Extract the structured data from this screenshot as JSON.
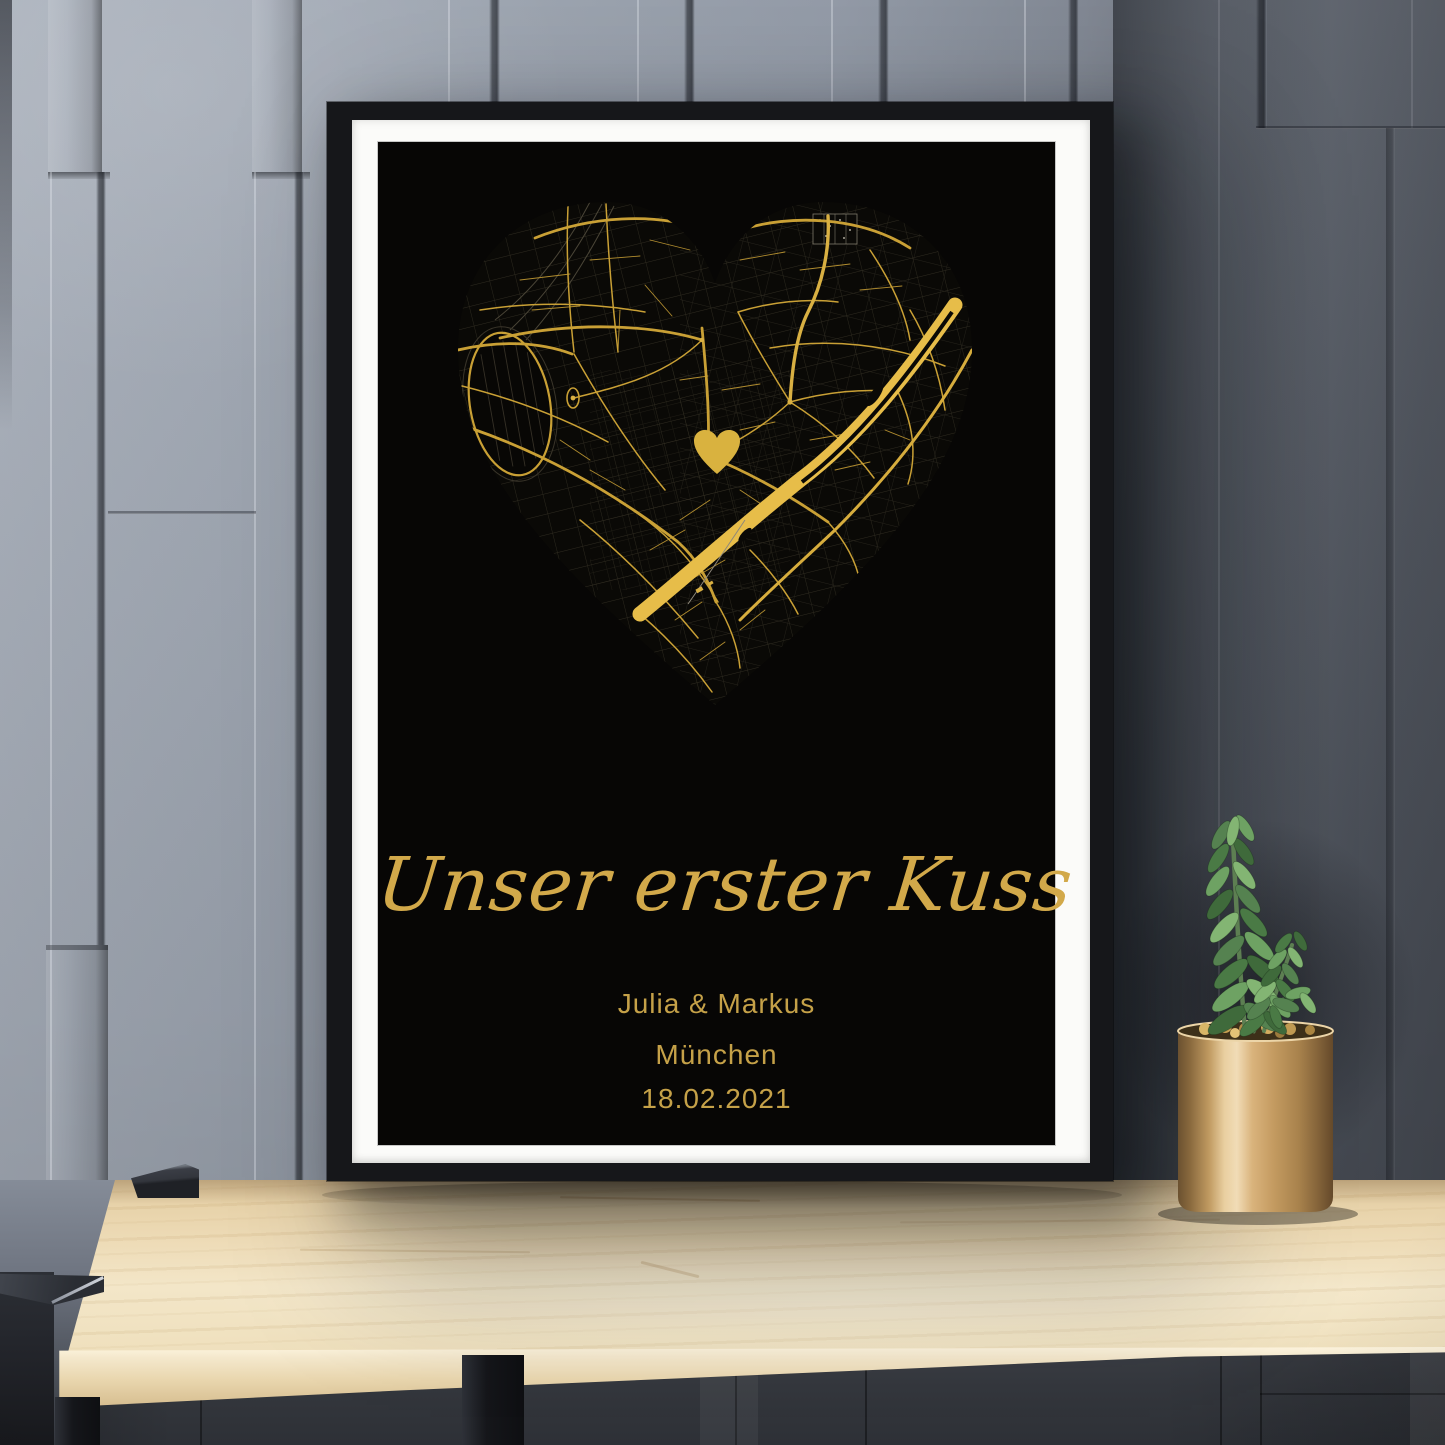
{
  "poster": {
    "title": "Unser erster Kuss",
    "names": "Julia & Markus",
    "city": "München",
    "date": "18.02.2021",
    "colors": {
      "gold_text": "#d2a94a",
      "map_gold": "#c9a035",
      "river_gold": "#e7bd49",
      "poster_background": "#070605",
      "mat": "#fbfbf9",
      "frame": "#16171a"
    },
    "map": {
      "marker_icon": "heart-icon"
    }
  },
  "scene": {
    "colors": {
      "wall_left": "#99a1ad",
      "wall_right": "#474b54",
      "table_wood": "#eedcb8",
      "pot_gold": "#c09a61",
      "plant_green": "#629459"
    }
  }
}
